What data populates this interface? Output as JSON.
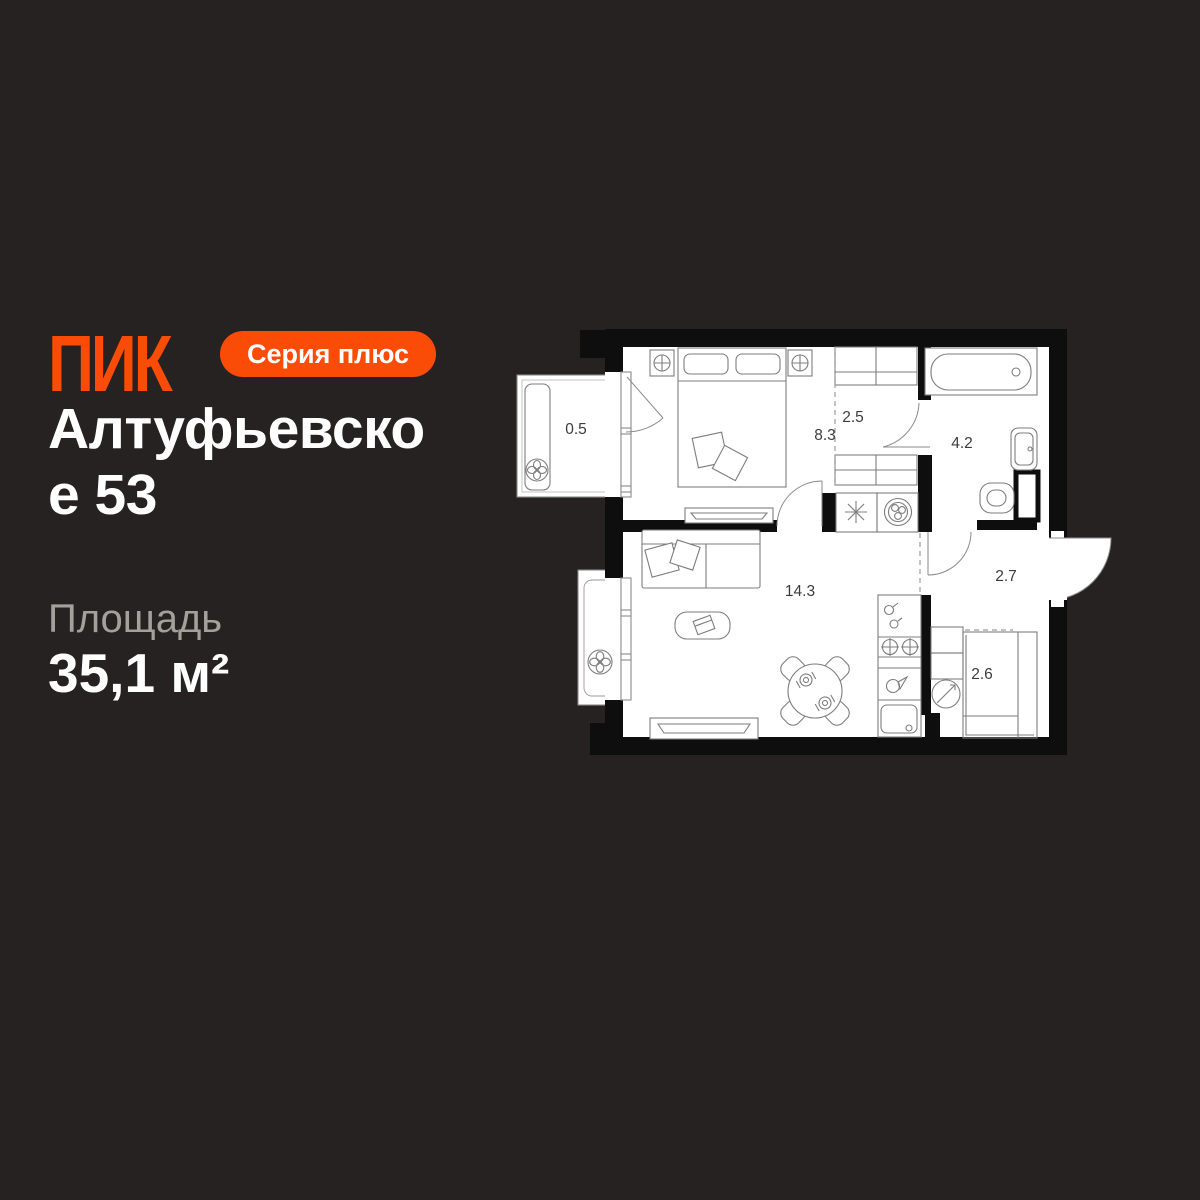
{
  "background_color": "#252221",
  "brand": {
    "logo_text": "ПИК",
    "badge_label": "Серия плюс",
    "accent_color": "#fb4c07"
  },
  "listing": {
    "title_lines": [
      "Алтуфьевско",
      "е 53"
    ],
    "area_label": "Площадь",
    "area_value": "35,1 м²"
  },
  "floor_plan": {
    "wall_color": "#0e0e0e",
    "paper_color": "#ffffff",
    "rooms": [
      {
        "name": "balcony",
        "area": "0.5"
      },
      {
        "name": "bedroom",
        "area": "8.3"
      },
      {
        "name": "wardrobe",
        "area": "2.5"
      },
      {
        "name": "bathroom",
        "area": "4.2"
      },
      {
        "name": "living-kitchen",
        "area": "14.3"
      },
      {
        "name": "hallway",
        "area": "2.7"
      },
      {
        "name": "storage",
        "area": "2.6"
      }
    ]
  }
}
